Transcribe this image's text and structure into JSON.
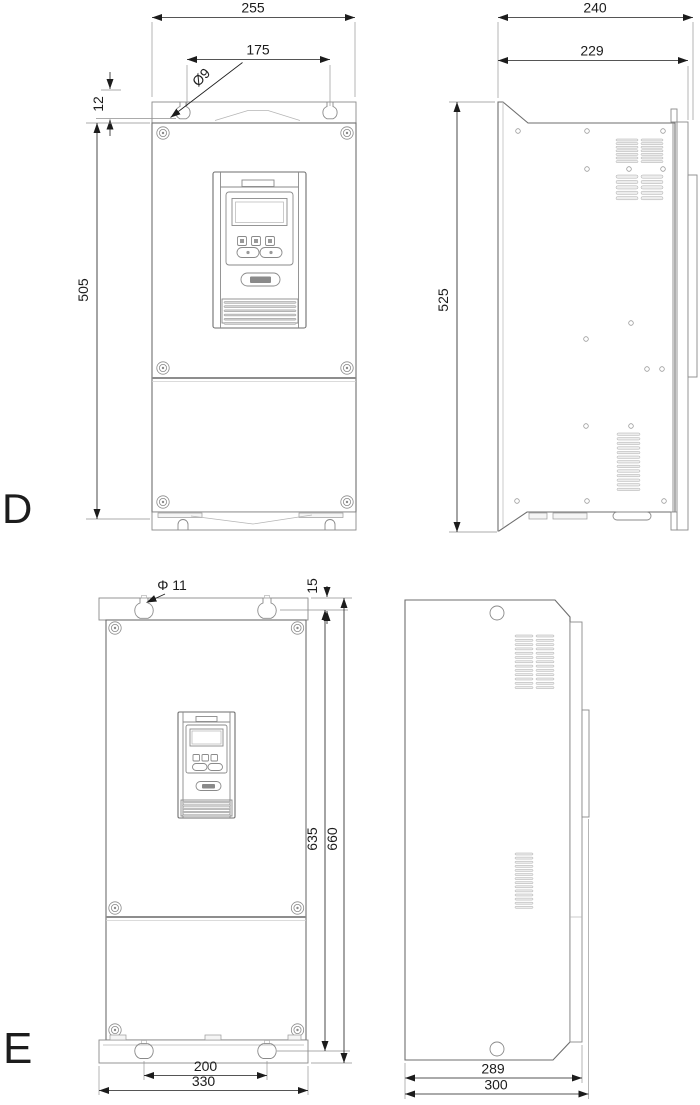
{
  "colors": {
    "accent_green": "#5cb843",
    "line_gray": "#6e6e6e"
  },
  "sections": {
    "d": {
      "label": "D",
      "front": {
        "width": "255",
        "hole_spacing": "175",
        "hole_dia": "Ø9",
        "top_offset": "12",
        "height": "505"
      },
      "side": {
        "depth": "240",
        "body_depth": "229",
        "height": "525"
      }
    },
    "e": {
      "label": "E",
      "front": {
        "hole_dia": "Φ 11",
        "top_offset": "15",
        "hole_height": "635",
        "height": "660",
        "bottom_hole_spacing": "200",
        "width": "330"
      },
      "side": {
        "body_depth": "289",
        "depth": "300"
      }
    }
  }
}
